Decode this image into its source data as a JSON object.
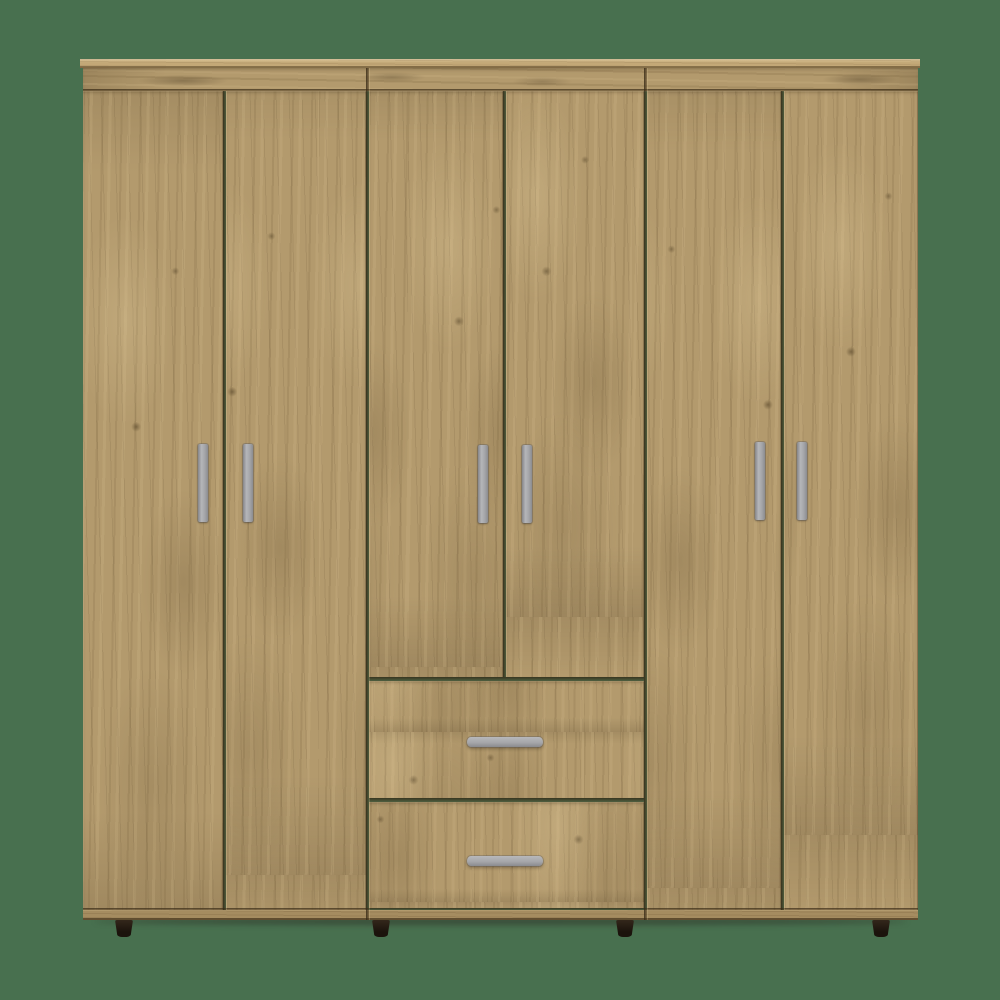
{
  "scene": {
    "description": "product photo of a six-door wardrobe with two drawers, no visible text",
    "background_color": "#48704F",
    "canvas": {
      "w": 1000,
      "h": 1000
    }
  },
  "wardrobe": {
    "finish_name": "light oak woodgrain",
    "palette": {
      "wood_base": "#b39a6d",
      "wood_light": "#c9b185",
      "wood_dark": "#6f5b3c",
      "top_board": "#c3a877",
      "base_strip": "#a58c60",
      "joint_line": "#342714",
      "handle_silver": "#a9aaad",
      "foot_dark": "#221911"
    },
    "counts": {
      "doors": 6,
      "drawers": 2,
      "door_handles": 6,
      "drawer_handles": 2,
      "feet": 4
    },
    "layout": {
      "top_board": {
        "x": 80,
        "y": 59,
        "w": 840,
        "h": 9
      },
      "header": {
        "x": 83,
        "y": 68,
        "w": 835,
        "h": 23
      },
      "doors": [
        {
          "id": "door-1",
          "x": 83,
          "y": 91,
          "w": 140,
          "h": 819,
          "grain": "0px 0px"
        },
        {
          "id": "door-2",
          "x": 226,
          "y": 91,
          "w": 140,
          "h": 819,
          "grain": "-47px -35px"
        },
        {
          "id": "door-3",
          "x": 369,
          "y": 91,
          "w": 134,
          "h": 586,
          "grain": "-95px -10px"
        },
        {
          "id": "door-4",
          "x": 506,
          "y": 91,
          "w": 138,
          "h": 586,
          "grain": "-150px -60px"
        },
        {
          "id": "door-5",
          "x": 647,
          "y": 91,
          "w": 134,
          "h": 819,
          "grain": "-198px -22px"
        },
        {
          "id": "door-6",
          "x": 784,
          "y": 91,
          "w": 134,
          "h": 819,
          "grain": "-252px -75px"
        }
      ],
      "drawers": [
        {
          "id": "drawer-1",
          "x": 369,
          "y": 681,
          "w": 275,
          "h": 117,
          "grain": "-60px -300px"
        },
        {
          "id": "drawer-2",
          "x": 369,
          "y": 802,
          "w": 275,
          "h": 106,
          "grain": "-170px -430px"
        }
      ],
      "base_strip": {
        "x": 83,
        "y": 910,
        "w": 835,
        "h": 10
      },
      "gaps_v": [
        {
          "x": 223,
          "y": 91,
          "h": 819
        },
        {
          "x": 366,
          "y": 68,
          "h": 852
        },
        {
          "x": 503,
          "y": 91,
          "h": 586
        },
        {
          "x": 644,
          "y": 68,
          "h": 852
        },
        {
          "x": 781,
          "y": 91,
          "h": 819
        }
      ],
      "gaps_h": [
        {
          "x": 83,
          "y": 89,
          "w": 835,
          "t": 2
        },
        {
          "x": 369,
          "y": 677,
          "w": 275,
          "t": 4
        },
        {
          "x": 369,
          "y": 798,
          "w": 275,
          "t": 4
        },
        {
          "x": 83,
          "y": 908,
          "w": 835,
          "t": 2
        }
      ],
      "door_handles": [
        {
          "x": 198,
          "y": 444
        },
        {
          "x": 243,
          "y": 444
        },
        {
          "x": 478,
          "y": 445
        },
        {
          "x": 522,
          "y": 445
        },
        {
          "x": 755,
          "y": 442
        },
        {
          "x": 797,
          "y": 442
        }
      ],
      "drawer_handles": [
        {
          "x": 467,
          "y": 737
        },
        {
          "x": 467,
          "y": 856
        }
      ],
      "feet": [
        {
          "x": 115
        },
        {
          "x": 372
        },
        {
          "x": 616
        },
        {
          "x": 872
        }
      ],
      "feet_y": 920,
      "ground_shadow": {
        "x": 95,
        "y": 918,
        "w": 812,
        "h": 7
      }
    }
  }
}
